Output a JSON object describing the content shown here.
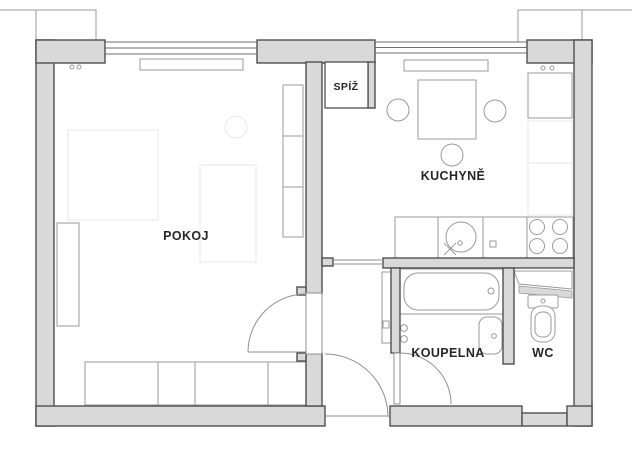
{
  "plan": {
    "rooms": [
      {
        "id": "pokoj",
        "label": "POKOJ"
      },
      {
        "id": "spiz",
        "label": "SPÍŽ"
      },
      {
        "id": "kuchyne",
        "label": "KUCHYNĚ"
      },
      {
        "id": "koupelna",
        "label": "KOUPELNA"
      },
      {
        "id": "wc",
        "label": "WC"
      }
    ],
    "fixtures": [
      "window",
      "radiator",
      "wardrobe",
      "dining-table",
      "chairs",
      "fridge",
      "kitchen-sink",
      "stove",
      "bathtub",
      "washbasin",
      "toilet",
      "door-swing"
    ],
    "colors": {
      "wall_fill": "#d9d9d9",
      "wall_stroke": "#4f4f4f",
      "furniture": "#9a9a9a",
      "faint": "#e7e7e7",
      "door": "#8f8f8f",
      "text": "#262626",
      "bg": "#ffffff"
    }
  }
}
